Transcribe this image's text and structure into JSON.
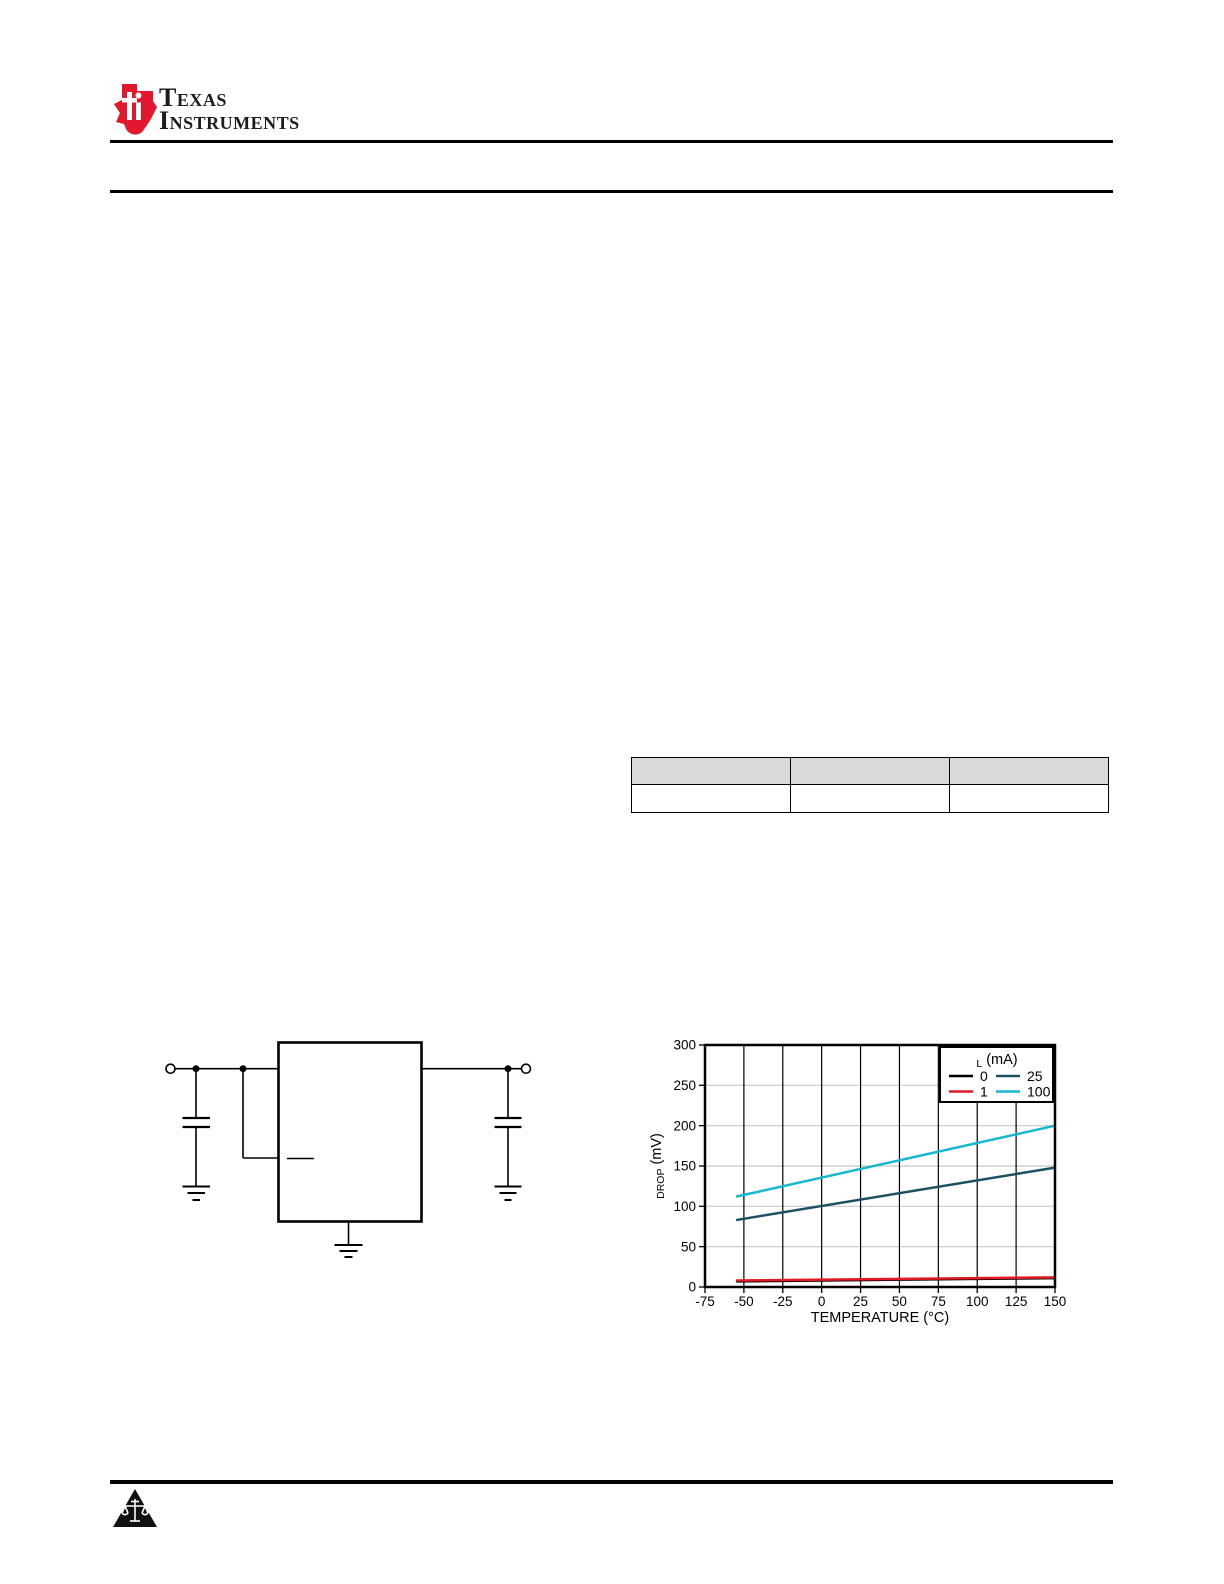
{
  "page": {
    "background": "#ffffff"
  },
  "header": {
    "logo_icon": "ti-bug-icon",
    "logo_color": "#e3172d",
    "brand_line1": "Texas",
    "brand_line2": "Instruments"
  },
  "table": {
    "header_bg": "#d9d9d9",
    "headers": [
      "",
      "",
      ""
    ],
    "rows": [
      [
        "",
        "",
        ""
      ]
    ]
  },
  "circuit": {
    "description": "typical-application-circuit",
    "elements": [
      "input-terminal",
      "input-capacitor",
      "regulator-ic-box",
      "active-low-pin-overline",
      "output-terminal",
      "output-capacitor",
      "ground-symbols"
    ]
  },
  "chart_data": {
    "type": "line",
    "title": "",
    "xlabel": "TEMPERATURE (°C)",
    "ylabel_main": "V",
    "ylabel_sub": "DROP",
    "ylabel_unit": " (mV)",
    "xlim": [
      -75,
      150
    ],
    "ylim": [
      0,
      300
    ],
    "xticks": [
      -75,
      -50,
      -25,
      0,
      25,
      50,
      75,
      100,
      125,
      150
    ],
    "yticks": [
      0,
      50,
      100,
      150,
      200,
      250,
      300
    ],
    "grid": {
      "vertical_color": "#000000",
      "horizontal_color": "#c8c8c8"
    },
    "legend": {
      "title_main": "I",
      "title_sub": "L",
      "title_unit": " (mA)",
      "position": "top-right",
      "rows": [
        [
          "0",
          "25"
        ],
        [
          "1",
          "100"
        ]
      ]
    },
    "series": [
      {
        "name": "0",
        "color": "#000000",
        "points": [
          [
            -55,
            7
          ],
          [
            150,
            11
          ]
        ]
      },
      {
        "name": "1",
        "color": "#e11a23",
        "points": [
          [
            -55,
            8
          ],
          [
            150,
            12
          ]
        ]
      },
      {
        "name": "25",
        "color": "#1c5163",
        "points": [
          [
            -55,
            83
          ],
          [
            150,
            148
          ]
        ]
      },
      {
        "name": "100",
        "color": "#17b8cf",
        "points": [
          [
            -55,
            112
          ],
          [
            150,
            200
          ]
        ]
      }
    ]
  },
  "footer": {
    "icon": "scales-triangle-icon"
  }
}
